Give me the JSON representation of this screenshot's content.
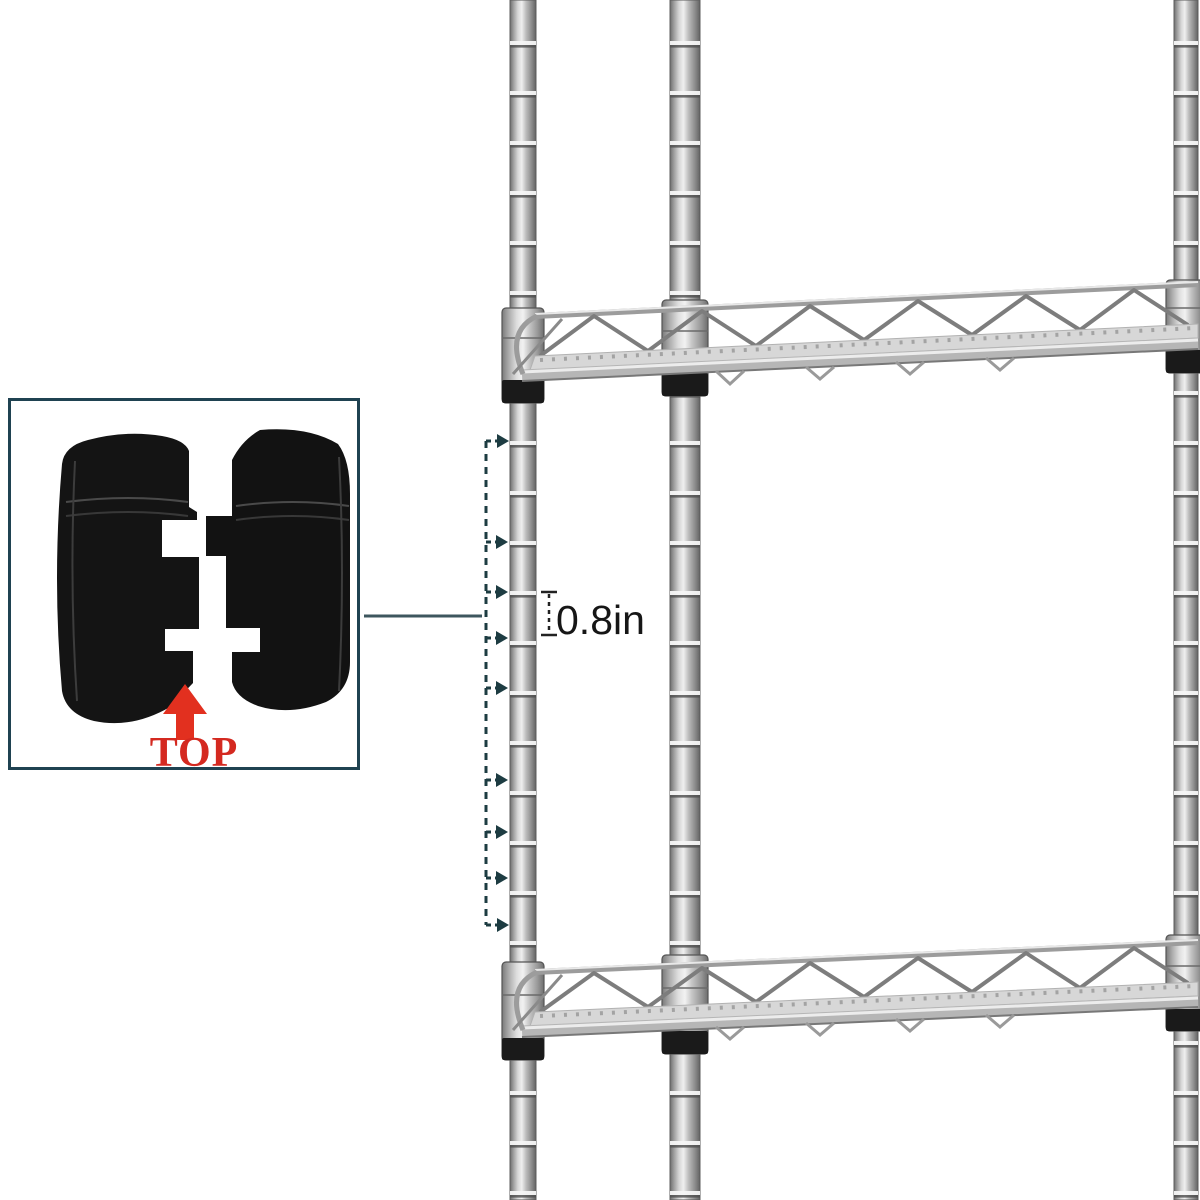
{
  "scene": {
    "background": "#ffffff",
    "pole_color": "#bdbdbd",
    "collar_band_color": "#1a1a1a",
    "shelf_wire_color": "#9c9c9c"
  },
  "annotations": {
    "measurement_label": "0.8in",
    "tick_count": 9,
    "line_color": "#1d3c42",
    "connector_color": "#3d565e"
  },
  "callout": {
    "label": "TOP",
    "label_color": "#d42920",
    "arrow_color": "#e2301f",
    "border_color": "#1f4251",
    "icon": "pole-lock-clip-pair"
  }
}
